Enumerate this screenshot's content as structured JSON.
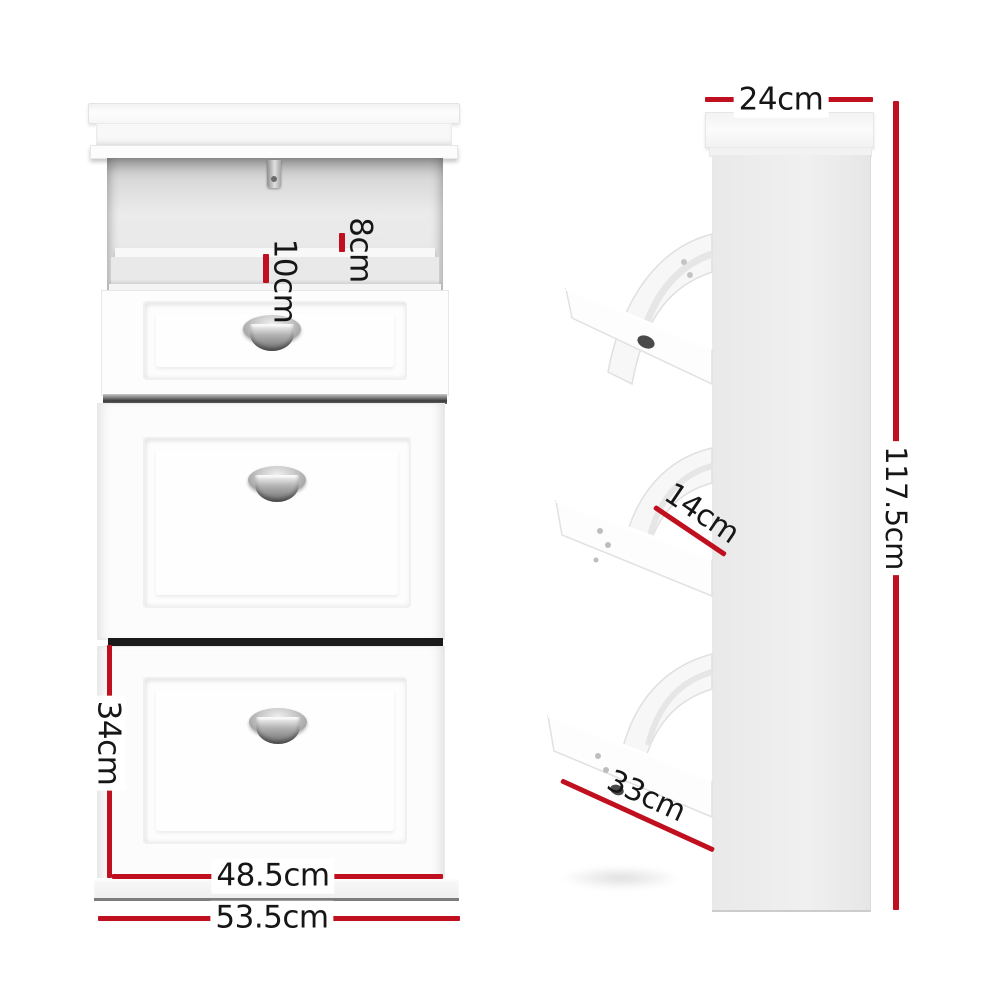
{
  "diagram": {
    "subject": "shoe cabinet dimension diagram",
    "views": {
      "front": "front view with open tip-out drawer",
      "side": "side view with three tip-out shelves"
    }
  },
  "colors": {
    "background": "#ffffff",
    "dimension_line_red": "#c00f1e",
    "label_text": "#161616",
    "cabinet_white": "#fbfbfb",
    "side_panel_gray": "#ededed",
    "separator_dark": "#1a1a1a"
  },
  "icons": {
    "handles": "cup-handle",
    "hinge": "hinge-catch"
  },
  "dimensions": {
    "shelf_top_back_depth": {
      "label": "8cm",
      "orientation": "vertical-rotated"
    },
    "shelf_top_front_depth": {
      "label": "10cm",
      "orientation": "vertical-rotated"
    },
    "bottom_drawer_height": {
      "label": "34cm",
      "orientation": "vertical"
    },
    "drawer_front_width": {
      "label": "48.5cm",
      "orientation": "horizontal"
    },
    "cabinet_width": {
      "label": "53.5cm",
      "orientation": "horizontal"
    },
    "cabinet_depth": {
      "label": "24cm",
      "orientation": "horizontal"
    },
    "cabinet_height": {
      "label": "117.5cm",
      "orientation": "vertical"
    },
    "shelf_opening_depth": {
      "label": "14cm",
      "orientation": "diagonal"
    },
    "shelf_board_length": {
      "label": "33cm",
      "orientation": "diagonal"
    }
  }
}
